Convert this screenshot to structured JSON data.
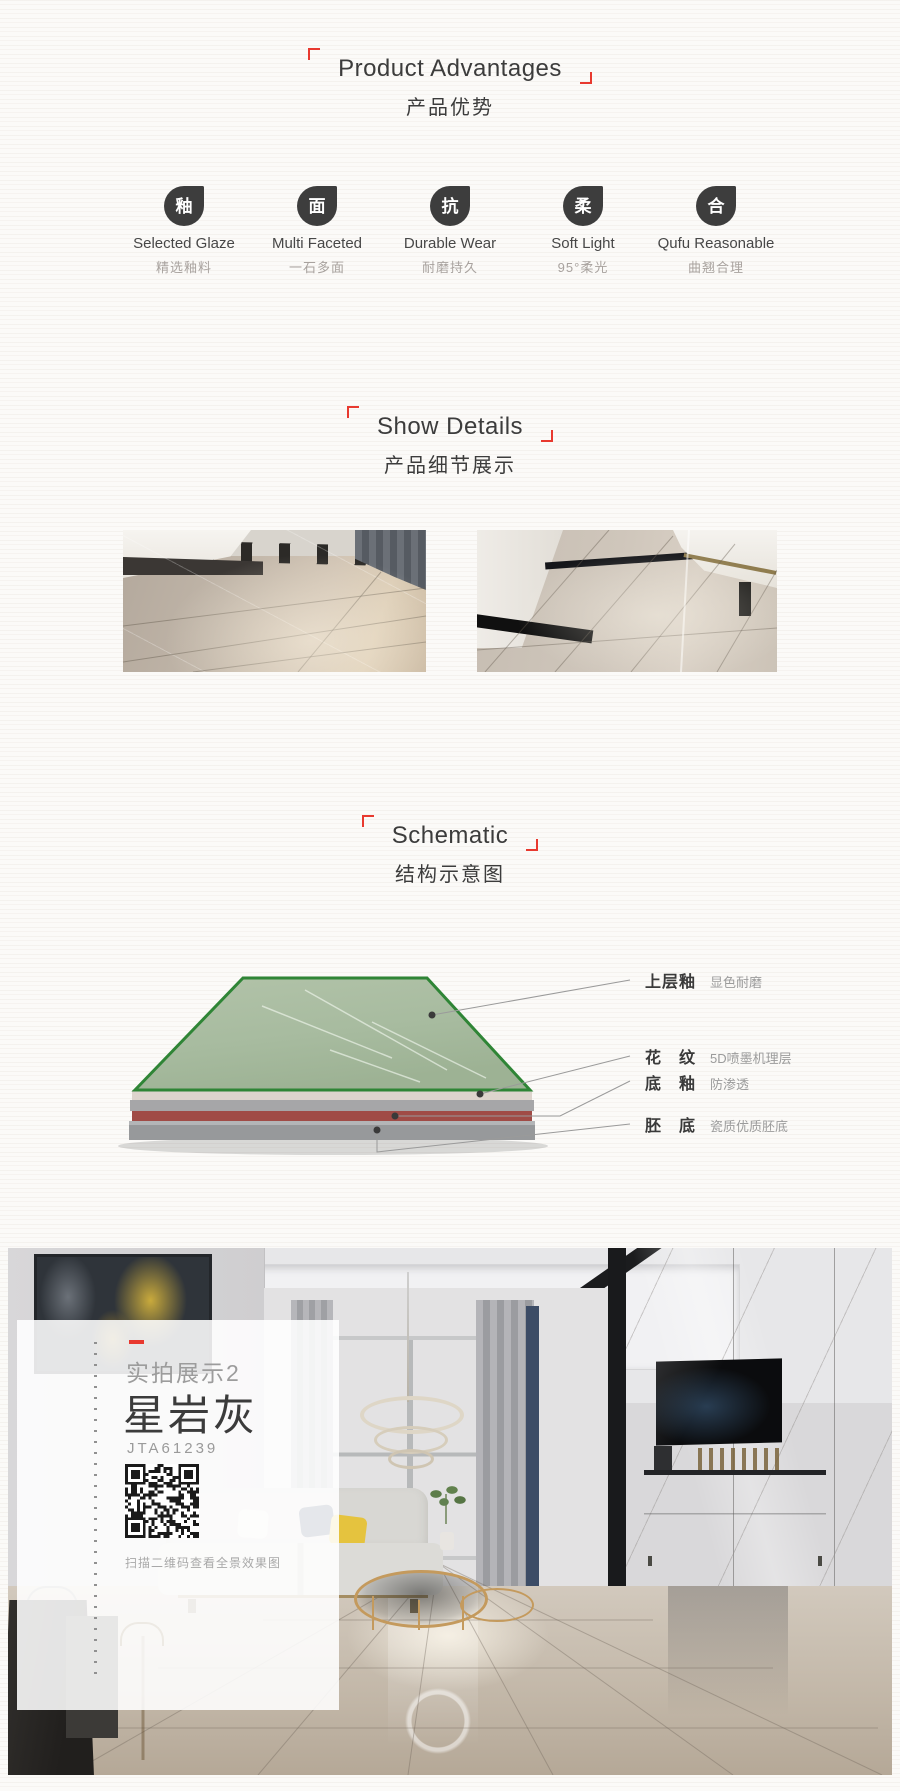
{
  "accent": {
    "red": "#e8392f",
    "icon_dark": "#3d3d3d"
  },
  "advantages": {
    "title_en": "Product Advantages",
    "title_zh": "产品优势",
    "items": [
      {
        "icon": "glaze-icon",
        "char": "釉",
        "en": "Selected Glaze",
        "zh": "精选釉料"
      },
      {
        "icon": "surface-icon",
        "char": "面",
        "en": "Multi Faceted",
        "zh": "一石多面"
      },
      {
        "icon": "wear-resist-icon",
        "char": "抗",
        "en": "Durable Wear",
        "zh": "耐磨持久"
      },
      {
        "icon": "soft-light-icon",
        "char": "柔",
        "en": "Soft Light",
        "zh": "95°柔光"
      },
      {
        "icon": "flatness-icon",
        "char": "合",
        "en": "Qufu Reasonable",
        "zh": "曲翘合理"
      }
    ]
  },
  "details": {
    "title_en": "Show Details",
    "title_zh": "产品细节展示"
  },
  "schematic": {
    "title_en": "Schematic",
    "title_zh": "结构示意图",
    "layers": [
      {
        "name": "上层釉",
        "desc": "显色耐磨"
      },
      {
        "name": "花　纹",
        "desc": "5D喷墨机理层"
      },
      {
        "name": "底　釉",
        "desc": "防渗透"
      },
      {
        "name": "胚　底",
        "desc": "瓷质优质胚底"
      }
    ],
    "colors": {
      "surface": "#a9bda2",
      "edge": "#2f8536",
      "glaze_layer": "#ddd4cd",
      "grey_layer": "#a6a6a8",
      "red_layer": "#a04b46",
      "base_layer": "#97999b"
    }
  },
  "showcase": {
    "tag": "实拍展示2",
    "name": "星岩灰",
    "model": "JTA61239",
    "qr_caption": "扫描二维码查看全景效果图"
  }
}
